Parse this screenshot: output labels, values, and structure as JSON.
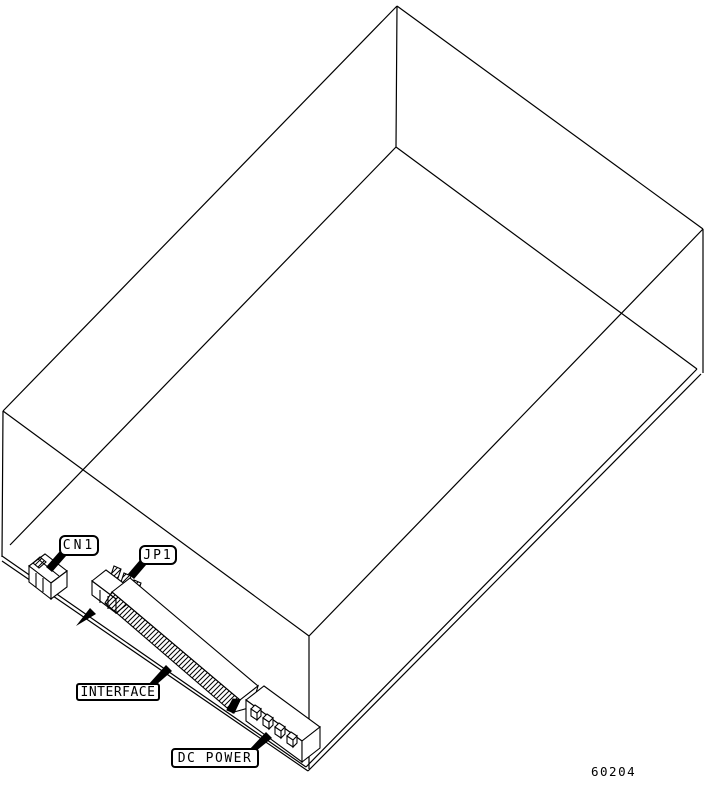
{
  "figure": {
    "number": "60204",
    "subject": "disk drive rear connector locations"
  },
  "callouts": {
    "cn1": {
      "label": "CN1"
    },
    "jp1": {
      "label": "JP1"
    },
    "interface": {
      "label": "INTERFACE"
    },
    "dc_power": {
      "label": "DC POWER"
    }
  },
  "colors": {
    "line": "#000000",
    "background": "#ffffff"
  }
}
